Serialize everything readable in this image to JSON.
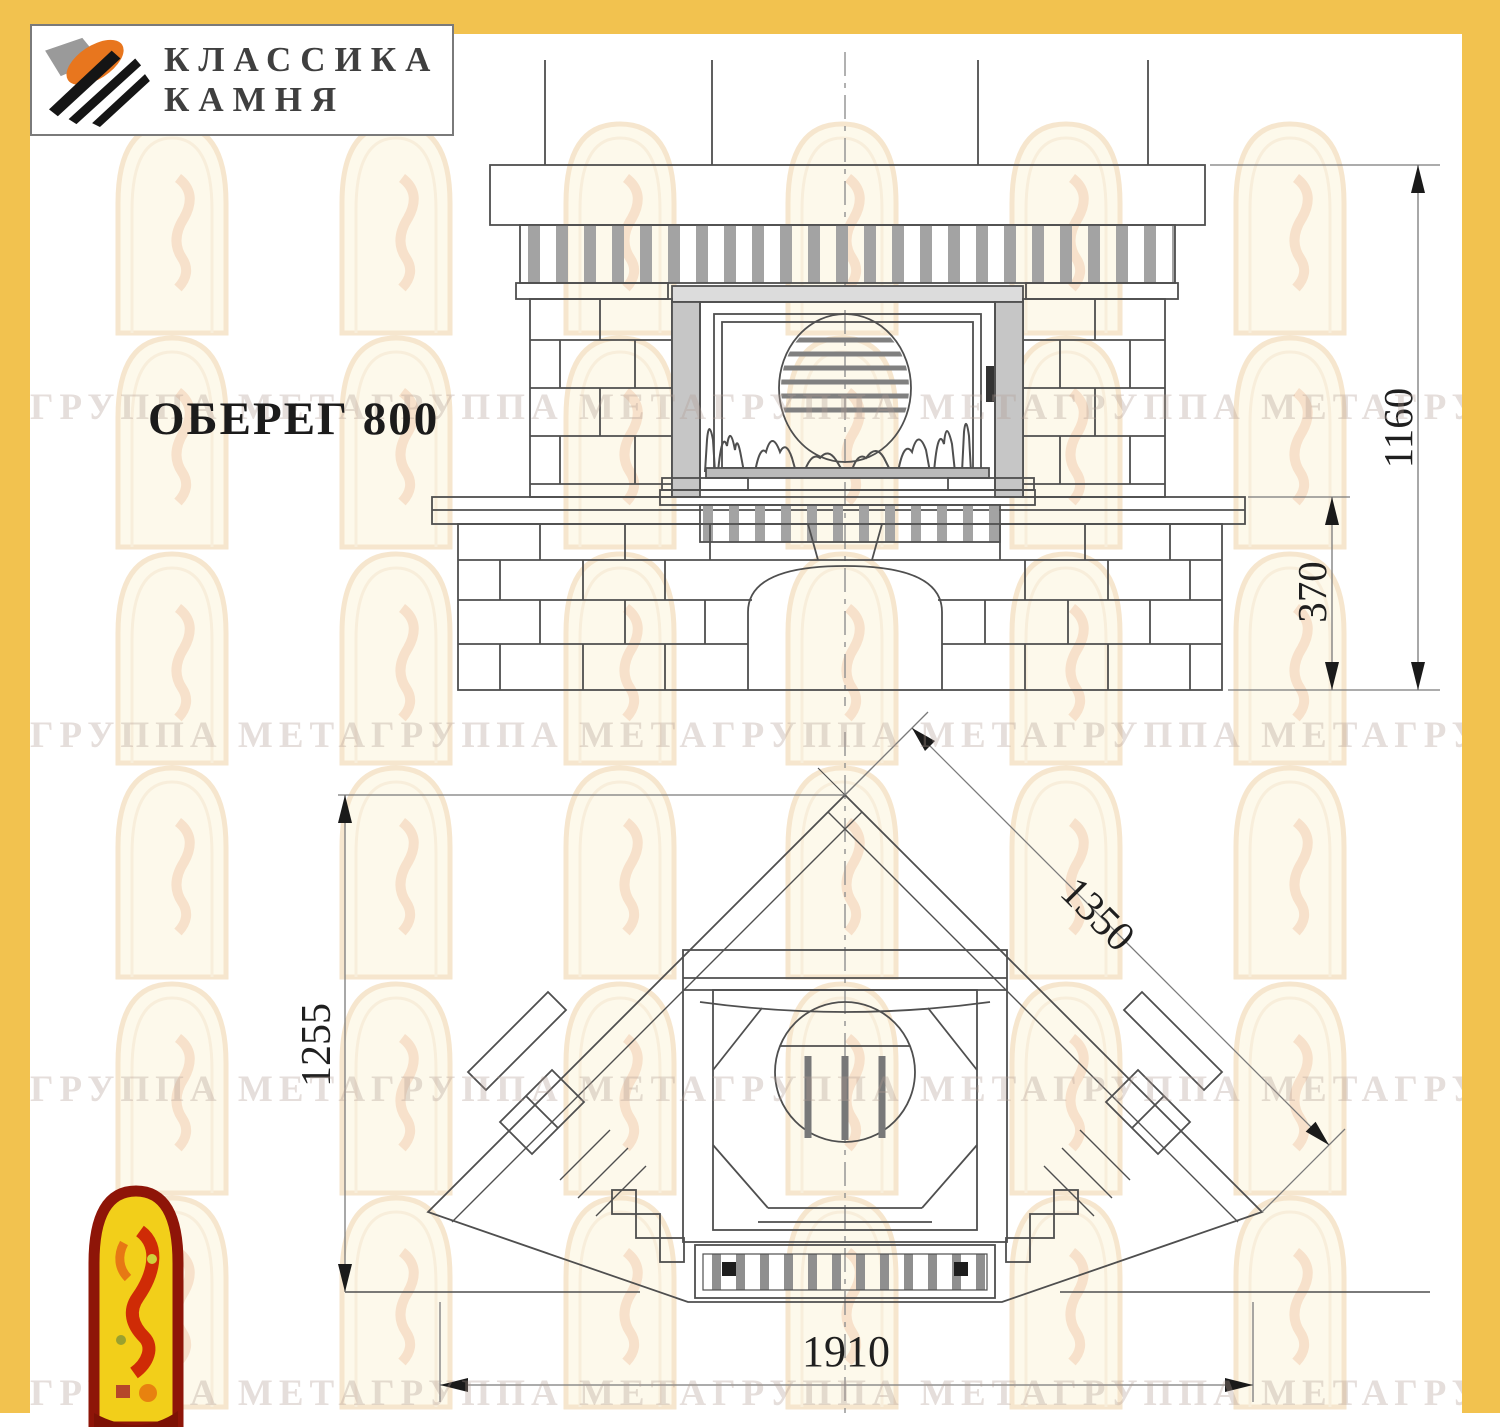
{
  "title": "ОБЕРЕГ 800",
  "brand": {
    "line1": "КЛАССИКА",
    "line2": "КАМНЯ"
  },
  "dimensions": {
    "front_total_height": "1160",
    "front_plinth_height": "370",
    "plan_depth": "1255",
    "plan_side": "1350",
    "plan_width": "1910"
  },
  "watermark": {
    "text": "ГРУППА МЕТАГРУППА МЕТАГРУППА МЕТАГРУППА МЕТАГРУППА МЕТА"
  },
  "colors": {
    "frame": "#f2c24f",
    "line": "#4f4f4f",
    "dim_line": "#777777",
    "dim_text": "#1f1f1f"
  }
}
